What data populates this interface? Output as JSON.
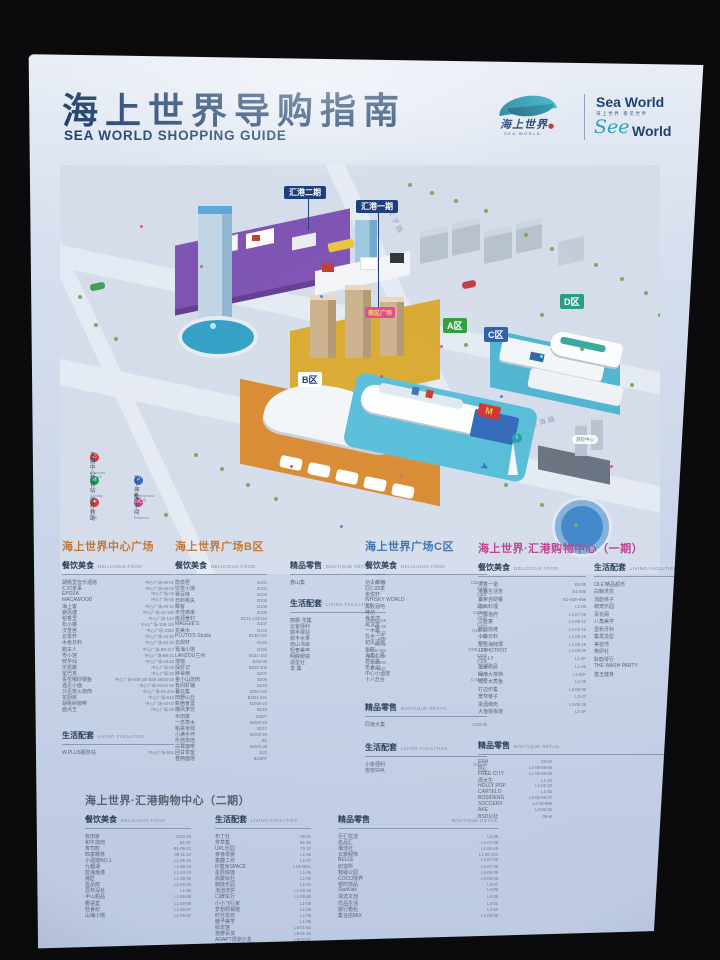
{
  "colors": {
    "title_navy": "#1d3f6b",
    "section_orange": "#bf7434",
    "section_blue": "#3a71ae",
    "section_magenta": "#bb3f8e",
    "section_slate": "#56616f",
    "map_green_zone": "#35a043",
    "map_teal_zone": "#2a9d8a",
    "map_blue_zone": "#2f62a8",
    "huigang_navy": "#1e3f7d",
    "plaza_pink": "#e14a9a"
  },
  "poster": {
    "title": {
      "zh": "海上世界导购指南",
      "en": "SEA WORLD SHOPPING GUIDE"
    },
    "brand": {
      "logo_script": "海上世界",
      "logo_sub": "SEA WORLD",
      "word1": "Sea World",
      "word2": "海上世界 看见世界",
      "see": "See",
      "world": "World"
    }
  },
  "map": {
    "zones": [
      {
        "label": "汇港二期"
      },
      {
        "label": "汇港一期"
      },
      {
        "label": "A区"
      },
      {
        "label": "B区"
      },
      {
        "label": "C区"
      },
      {
        "label": "D区"
      }
    ],
    "plaza_label": "南区广场",
    "cruise_label": "游轮中心",
    "roads": [
      {
        "label": "太子路"
      },
      {
        "label": "望海路"
      }
    ],
    "mcdonalds_m": "M",
    "legend": [
      {
        "zh": "客服中心",
        "en": "Customer Service",
        "g": "✆",
        "color": "#d03c3c"
      },
      {
        "zh": "地铁站",
        "en": "Subway",
        "g": "M",
        "color": "#1f9e4b"
      },
      {
        "zh": "地下停车场",
        "en": "Underground Parking",
        "g": "P",
        "color": "#2f6cc4"
      },
      {
        "zh": "医疗救助",
        "en": "AED",
        "g": "✚",
        "color": "#d03c3c"
      },
      {
        "zh": "洗手间",
        "en": "Restroom",
        "g": "WC",
        "color": "#d23b8a"
      }
    ]
  },
  "sections": [
    {
      "title": "海上世界中心广场",
      "groups": [
        {
          "zh": "餐饮美食",
          "en": "DELICIOUS FOOD",
          "items": [
            {
              "n": "胡桃里音乐酒馆",
              "c": "中心广场-09-01"
            },
            {
              "n": "仁村茶事",
              "c": "中心广场-09-04"
            },
            {
              "n": "EPOZA",
              "c": "中心广场-03"
            },
            {
              "n": "MACAWOOD",
              "c": "中心广场-05"
            },
            {
              "n": "海上客",
              "c": "中心广场-29-12"
            },
            {
              "n": "避风塘",
              "c": "中心广场-22-180"
            },
            {
              "n": "稻香里",
              "c": "中心广场-12A"
            },
            {
              "n": "松小椿",
              "c": "中心广场-108-116"
            },
            {
              "n": "汉釜宫",
              "c": "中心广场-10B2"
            },
            {
              "n": "云季轩",
              "c": "中心广场-16-20"
            },
            {
              "n": "木垚日料",
              "c": "中心广场-16-22"
            },
            {
              "n": "鹅夫人",
              "c": "中心广场-B6-117"
            },
            {
              "n": "粤小馆",
              "c": "中心广场-B6-21"
            },
            {
              "n": "鲜芋仙",
              "c": "中心广场-18-20"
            },
            {
              "n": "乐凯撒",
              "c": "中心广场-09"
            },
            {
              "n": "星巴克",
              "c": "中心广场-20"
            },
            {
              "n": "青花椒砂锅鱼",
              "c": "中心广场-005-20/-B26-29/30-20"
            },
            {
              "n": "遇见小面",
              "c": "中心广场-03-04-20"
            },
            {
              "n": "只见炭火烧肉",
              "c": "中心广场-04-204"
            },
            {
              "n": "花厨房",
              "c": "中心广场-B10"
            },
            {
              "n": "胡桃树咖啡",
              "c": "中心广场-04-07"
            },
            {
              "n": "面点王",
              "c": "中心广场-06"
            }
          ]
        },
        {
          "zh": "生活配套",
          "en": "LIVING FACILITIES",
          "items": [
            {
              "n": "W.PLUS服务站",
              "c": "中心广场-B01"
            }
          ]
        }
      ]
    },
    {
      "title": "海上世界广场B区",
      "groups": [
        {
          "zh": "餐饮美食",
          "en": "DELICIOUS FOOD",
          "items": [
            {
              "n": "隐泉居",
              "c": "B101"
            },
            {
              "n": "饮茶小馆",
              "c": "B102"
            },
            {
              "n": "赛百味",
              "c": "B104"
            },
            {
              "n": "日料桃矢",
              "c": "B106"
            },
            {
              "n": "椰客",
              "c": "B108"
            },
            {
              "n": "丰茂烤串",
              "c": "B109"
            },
            {
              "n": "桃源眷村",
              "c": "B131-133/110"
            },
            {
              "n": "MAGGIE'S",
              "c": "B107"
            },
            {
              "n": "花美木",
              "c": "B142"
            },
            {
              "n": "PLUTO'S Studio",
              "c": "B130-142"
            },
            {
              "n": "云鼎轩",
              "c": "B145"
            },
            {
              "n": "靠海小馆",
              "c": "B150"
            },
            {
              "n": "LANZOU兰州",
              "c": "B151-152"
            },
            {
              "n": "漫咖",
              "c": "B2M-02"
            },
            {
              "n": "探虾记",
              "c": "B203-305"
            },
            {
              "n": "胖哥俩",
              "c": "B207"
            },
            {
              "n": "金小山烧肉",
              "c": "B209"
            },
            {
              "n": "有间虾铺",
              "c": "B210"
            },
            {
              "n": "暮云集",
              "c": "B2M-142"
            },
            {
              "n": "田野山丘",
              "c": "B2M4-241"
            },
            {
              "n": "新宿食堂",
              "c": "B2M5-24"
            },
            {
              "n": "椿风茶饮",
              "c": "B215"
            },
            {
              "n": "禾田家",
              "c": "B2M7"
            },
            {
              "n": "一念草木",
              "c": "B2M2-24"
            },
            {
              "n": "稻来米线",
              "c": "B217"
            },
            {
              "n": "小满手作",
              "c": "B2M9-26"
            },
            {
              "n": "乐焙烘焙",
              "c": "B2"
            },
            {
              "n": "白鹭咖啡",
              "c": "B2M3-28"
            },
            {
              "n": "回甘茶室",
              "c": "B22"
            },
            {
              "n": "叁两面馆",
              "c": "B2M07"
            }
          ]
        },
        {
          "zh": "精品零售",
          "en": "BOUTIQUE RETAIL",
          "items": [
            {
              "n": "春山集",
              "c": "B2-02"
            }
          ]
        },
        {
          "zh": "生活配套",
          "en": "LIVING FACILITIES",
          "items": [
            {
              "n": "丽枫·市集",
              "c": "78-M-128"
            },
            {
              "n": "云客便利",
              "c": "B1-25"
            },
            {
              "n": "顺丰驿站",
              "c": "B-32"
            },
            {
              "n": "鲜丰水果",
              "c": "21M"
            },
            {
              "n": "南山书房",
              "c": "B4-02"
            },
            {
              "n": "轻奢美甲",
              "c": "BW98-360"
            },
            {
              "n": "明眸眼镜",
              "c": "WM6-45X"
            },
            {
              "n": "造型社",
              "c": "S-12560"
            },
            {
              "n": "发·集",
              "c": "S-12537"
            }
          ]
        }
      ]
    },
    {
      "title": "海上世界广场C区",
      "groups": [
        {
          "zh": "餐饮美食",
          "en": "DELICIOUS FOOD",
          "items": [
            {
              "n": "功夫茶馆",
              "c": "C02-064"
            },
            {
              "n": "同仁四季",
              "c": "C020"
            },
            {
              "n": "金悦轩",
              "c": "C301"
            },
            {
              "n": "WHISKY WORLD",
              "c": "C06"
            },
            {
              "n": "黑胶酒吧",
              "c": "C049"
            },
            {
              "n": "啤坊",
              "c": "C14-02"
            },
            {
              "n": "眷茶湾",
              "c": "C034"
            },
            {
              "n": "黑泷堂",
              "c": "C123"
            },
            {
              "n": "一木森",
              "c": "C1M-10"
            },
            {
              "n": "在水一方",
              "c": "C18"
            },
            {
              "n": "初见酒馆",
              "c": "S-27"
            },
            {
              "n": "乐町",
              "c": "C09L-103"
            },
            {
              "n": "海角七号",
              "c": "C069"
            },
            {
              "n": "君悦荟",
              "c": "C169"
            },
            {
              "n": "觅食记",
              "c": "C36"
            },
            {
              "n": "中心小酒馆",
              "c": "C1-3"
            },
            {
              "n": "十八灶台",
              "c": "C-10799"
            }
          ]
        },
        {
          "zh": "精品零售",
          "en": "BOUTIQUE RETAIL",
          "items": [
            {
              "n": "同渔大集",
              "c": "C2M-05"
            }
          ]
        },
        {
          "zh": "生活配套",
          "en": "LIVING FACILITIES",
          "items": [
            {
              "n": "小象便利",
              "c": "C04-05"
            },
            {
              "n": "悦容SPA",
              "c": "C-92"
            }
          ]
        }
      ]
    },
    {
      "title": "海上世界·汇港购物中心（一期）",
      "groups": [
        {
          "zh": "餐饮美食",
          "en": "DELICIOUS FOOD",
          "items": [
            {
              "n": "清真一诺",
              "c": "B2-08"
            },
            {
              "n": "港囊生活茶",
              "c": "B1-060"
            },
            {
              "n": "寰宇自助餐",
              "c": "B1-048~059"
            },
            {
              "n": "隐石料理",
              "c": "L1-05"
            },
            {
              "n": "巴蜀渔府",
              "c": "L1-07-08"
            },
            {
              "n": "三秋宴",
              "c": "L1-09-12"
            },
            {
              "n": "野韵烧烤",
              "c": "L1-02-15"
            },
            {
              "n": "小葵日料",
              "c": "L1-06-18"
            },
            {
              "n": "莆苗海鲜焗",
              "c": "L1-06-19"
            },
            {
              "n": "123HOTPOT",
              "c": "L1-08-29"
            },
            {
              "n": "552-LY",
              "c": "L1-2F"
            },
            {
              "n": "望潮甜品",
              "c": "L1-26"
            },
            {
              "n": "闽南大排档",
              "c": "L1-02F"
            },
            {
              "n": "椒爱水煮鱼",
              "c": "L2-06"
            },
            {
              "n": "打边炉集",
              "c": "L2-06-08"
            },
            {
              "n": "宽窄巷子",
              "c": "L2-07"
            },
            {
              "n": "柒酒烤肉",
              "c": "L2-08-28"
            },
            {
              "n": "大渔铁板烧",
              "c": "L2-2F"
            }
          ]
        },
        {
          "zh": "生活配套",
          "en": "LIVING FACILITIES",
          "items": [
            {
              "n": "OLE'精品超市",
              "c": "B1"
            },
            {
              "n": "白鲸洗衣",
              "c": "B1-62"
            },
            {
              "n": "浅韵亲子",
              "c": "B1-58"
            },
            {
              "n": "萌宠乐园",
              "c": "B1-9F"
            },
            {
              "n": "百花阁",
              "c": "B2-76A-250"
            },
            {
              "n": "八角美学",
              "c": "B1-2F"
            },
            {
              "n": "壹帆牙科",
              "c": "B1-09E"
            },
            {
              "n": "集发造型",
              "c": "B2-01"
            },
            {
              "n": "美容湾",
              "c": "B5-03"
            },
            {
              "n": "笑研社",
              "c": "B6-55D"
            },
            {
              "n": "聆韵琴行",
              "c": "L1-01-30"
            },
            {
              "n": "THE WASH PARTY",
              "c": "L1-06-30"
            },
            {
              "n": "基玉健身",
              "c": "L1-M"
            }
          ]
        },
        {
          "zh": "精品零售",
          "en": "BOUTIQUE RETAIL",
          "items": [
            {
              "n": "ERA",
              "c": "05-02"
            },
            {
              "n": "MJ",
              "c": "L1-05-05-06"
            },
            {
              "n": "FREE CITY",
              "c": "L1-05-06-08"
            },
            {
              "n": "周大生",
              "c": "L1-20"
            },
            {
              "n": "HOLLY POP",
              "c": "L1-02-20"
            },
            {
              "n": "CARTELO",
              "c": "L1-05"
            },
            {
              "n": "BOSIDENG",
              "c": "L2-05-06-07"
            },
            {
              "n": "SOCCERX",
              "c": "L2-06-098"
            },
            {
              "n": "AKE",
              "c": "L2-05-25"
            },
            {
              "n": "BSD公社",
              "c": "05-M"
            }
          ]
        }
      ]
    },
    {
      "title": "海上世界·汇港购物中心（二期）",
      "groups": [
        {
          "zh": "餐饮美食",
          "en": "DELICIOUS FOOD",
          "items": [
            {
              "n": "有田家",
              "c": "2019-20"
            },
            {
              "n": "和牛烧肉",
              "c": "B1-07"
            },
            {
              "n": "寿司町",
              "c": "B1-09-12"
            },
            {
              "n": "四季椰林",
              "c": "09-11-13"
            },
            {
              "n": "小酒馆NO.1",
              "c": "L1-05-26"
            },
            {
              "n": "九鲤湖",
              "c": "L1-08-10"
            },
            {
              "n": "蓝海渔港",
              "c": "L1-44-10"
            },
            {
              "n": "烤匠",
              "c": "L1-06-05"
            },
            {
              "n": "壹品鲜",
              "c": "L1-05-02"
            },
            {
              "n": "荔林深处",
              "c": "L1-05"
            },
            {
              "n": "半山甜品",
              "c": "L1-06-06"
            },
            {
              "n": "椰语堂",
              "c": "L1-16-06"
            },
            {
              "n": "轻食纪",
              "c": "L1-06-07"
            },
            {
              "n": "山海小馆",
              "c": "L1-06-37"
            }
          ]
        },
        {
          "zh": "生活配套",
          "en": "LIVING FACILITIES",
          "items": [
            {
              "n": "布丁社",
              "c": "06-01"
            },
            {
              "n": "芳草集",
              "c": "B1-05"
            },
            {
              "n": "UPL乐园",
              "c": "70-12"
            },
            {
              "n": "亲亲母婴",
              "c": "L1-06"
            },
            {
              "n": "童趣工坊",
              "c": "L1-07"
            },
            {
              "n": "IF健身SPACE",
              "c": "L15-0561"
            },
            {
              "n": "星辰瑜伽",
              "c": "L1-05"
            },
            {
              "n": "启蒙绘社",
              "c": "L1-06"
            },
            {
              "n": "萌娃乐园",
              "c": "L1-62"
            },
            {
              "n": "泡泡洗护",
              "c": "L1-05-26"
            },
            {
              "n": "口碑车行",
              "c": "L1-05-88"
            },
            {
              "n": "小小飞行家",
              "c": "L1-09"
            },
            {
              "n": "梦想照相馆",
              "c": "L1-08"
            },
            {
              "n": "时光花坊",
              "c": "L1-05"
            },
            {
              "n": "鹿予美学",
              "c": "L1-06"
            },
            {
              "n": "绘本馆",
              "c": "L6-01-52"
            },
            {
              "n": "拾野百货",
              "c": "L9-01-20"
            },
            {
              "n": "ADAPT烫染沙龙",
              "c": "L9-02-57"
            },
            {
              "n": "滨海驿站",
              "c": "L9-08"
            }
          ]
        },
        {
          "zh": "精品零售",
          "en": "BOUTIQUE RETAIL",
          "items": [
            {
              "n": "巨汇优选",
              "c": "L1-08"
            },
            {
              "n": "名品汇",
              "c": "L1-07-08"
            },
            {
              "n": "潮流社",
              "c": "L1-50-16"
            },
            {
              "n": "云裳服饰",
              "c": "L1-08-104"
            },
            {
              "n": "BELLE",
              "c": "L1-07-05"
            },
            {
              "n": "织造所",
              "c": "L1-07-06"
            },
            {
              "n": "鞋履公园",
              "c": "L0-06-05"
            },
            {
              "n": "COCO饰界",
              "c": "L0-06-06"
            },
            {
              "n": "银时饰品",
              "c": "L4-07"
            },
            {
              "n": "StarKids",
              "c": "L4-09"
            },
            {
              "n": "漫选文创",
              "c": "L4-08"
            },
            {
              "n": "优品生活",
              "c": "L4-01"
            },
            {
              "n": "旅行箱包",
              "c": "L4-02"
            },
            {
              "n": "集合店MIX",
              "c": "L1-06-06"
            }
          ]
        }
      ]
    }
  ]
}
